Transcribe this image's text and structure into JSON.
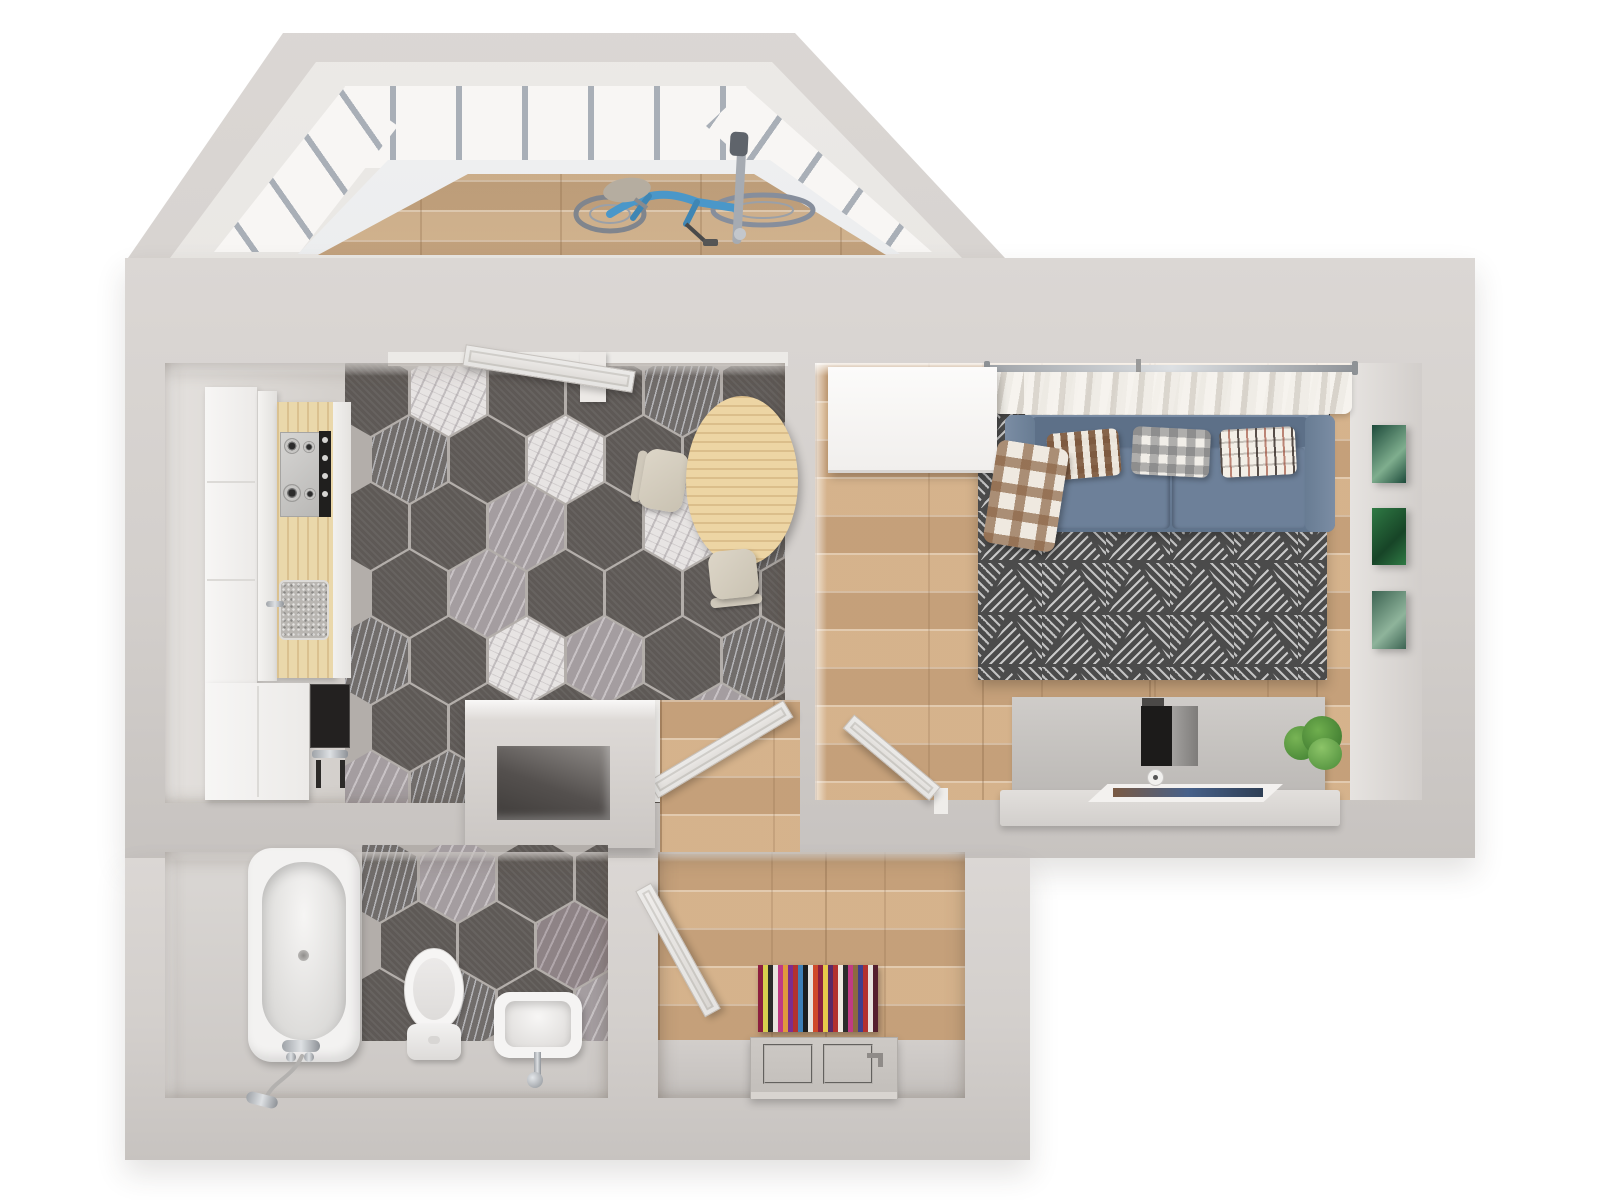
{
  "scene": {
    "type": "3d-floor-plan-top-view",
    "background": "#ffffff",
    "rooms": [
      "balcony",
      "kitchen",
      "living-room",
      "bathroom",
      "hallway",
      "corridor",
      "ventilation-shaft"
    ]
  },
  "palette": {
    "wall": "#d3cfcc",
    "wall_hi": "#dbd7d4",
    "wall_lo": "#c7c3c0",
    "wall_face": "#e8e5e2",
    "wood": "#cfab84",
    "wood_balcony": "#d7b68f",
    "grout": "#b3aeaa",
    "tile_dark": "#5e5956",
    "tile_white": "#e7e4e3",
    "tile_gray": "#a49da0",
    "tile_striated": "#716d6b",
    "tile_mauve": "#8e8386",
    "bath_floor": "#d6d3d0",
    "cabinet_white": "#f3f2f0",
    "counter_wood": "#ead8ab",
    "stove_steel": "#c9c8c6",
    "sink_gray": "#b9b6b2",
    "appliance_dark": "#262422",
    "table_wood": "#edd5a4",
    "chair_beige": "#d9d3c6",
    "sofa_blue": "#6d8099",
    "sofa_blue_dark": "#5d7088",
    "sofa_blue_light": "#7b8da4",
    "rug_base": "#4b4b4b",
    "rug_line": "#c8c8c8",
    "curtain": "#f3f0eb",
    "curtain_shade": "#d8d3cb",
    "chrome": "#b6bac0",
    "desk_gray": "#c9c6c3",
    "desk_top": "#dcd9d6",
    "plant_green": "#57953f",
    "door_slab": "#e7e4e1",
    "porcelain": "#f5f4f3",
    "bike_blue": "#4a97c9",
    "bike_wheel": "#868e9c"
  },
  "balcony": {
    "glazing_mullions_top": 6,
    "glazing_mullions_left": 3,
    "glazing_mullions_right": 3,
    "objects": [
      "bicycle"
    ]
  },
  "kitchen": {
    "hex_map": [
      [
        "D",
        "W",
        "D",
        "D",
        "S",
        "D"
      ],
      [
        "S",
        "D",
        "W",
        "D",
        "D",
        "G"
      ],
      [
        "D",
        "D",
        "G",
        "D",
        "W",
        "S"
      ],
      [
        "D",
        "G",
        "D",
        "D",
        "D",
        "D"
      ],
      [
        "S",
        "D",
        "W",
        "G",
        "D",
        "S"
      ],
      [
        "D",
        "D",
        "D",
        "D",
        "G",
        "D"
      ],
      [
        "G",
        "S",
        "D",
        "W",
        "D",
        "D"
      ]
    ],
    "objects": [
      "tall-cabinet",
      "counter",
      "gas-hob",
      "sink",
      "oven",
      "dining-table",
      "chair",
      "chair",
      "open-balcony-door"
    ]
  },
  "bathroom": {
    "hex_map": [
      [
        "S",
        "G",
        "D",
        "D"
      ],
      [
        "D",
        "D",
        "M",
        "W"
      ],
      [
        "D",
        "S",
        "D",
        "G"
      ]
    ],
    "objects": [
      "bathtub",
      "shower-mixer",
      "toilet",
      "washbasin"
    ]
  },
  "living_room": {
    "objects": [
      "wardrobe",
      "curtains",
      "radiator",
      "sofa",
      "throw-blanket",
      "rug",
      "tv-console",
      "monitor",
      "plant",
      "magazine",
      "open-door"
    ],
    "pillows": [
      {
        "style": "mosaic"
      },
      {
        "style": "gingham"
      },
      {
        "style": "ikat"
      }
    ],
    "pictures": [
      [
        "#1d4a3b",
        "#7fae8e"
      ],
      [
        "#2f7a44",
        "#174427"
      ],
      [
        "#3c6352",
        "#8fb49b"
      ]
    ]
  },
  "hallway": {
    "objects": [
      "striped-rug",
      "entrance-door",
      "open-door"
    ],
    "rug_stripes": [
      "#8c1f3f",
      "#d8cf4e",
      "#2b2b2b",
      "#e8e4df",
      "#c03b84",
      "#e09a3c",
      "#7c2d8e",
      "#b3322e",
      "#3f7fb5",
      "#1d1d1d",
      "#e8e4df",
      "#cf4a2a",
      "#8c1f3f",
      "#e7c84a",
      "#5a2a66",
      "#b3322e",
      "#efe9e2",
      "#2b2b2b",
      "#c03b84",
      "#8c6a3f",
      "#3f3f8c",
      "#b3322e",
      "#e8e4df",
      "#541f2e"
    ]
  },
  "ventilation_shaft": {
    "objects": [
      "duct-opening"
    ]
  }
}
